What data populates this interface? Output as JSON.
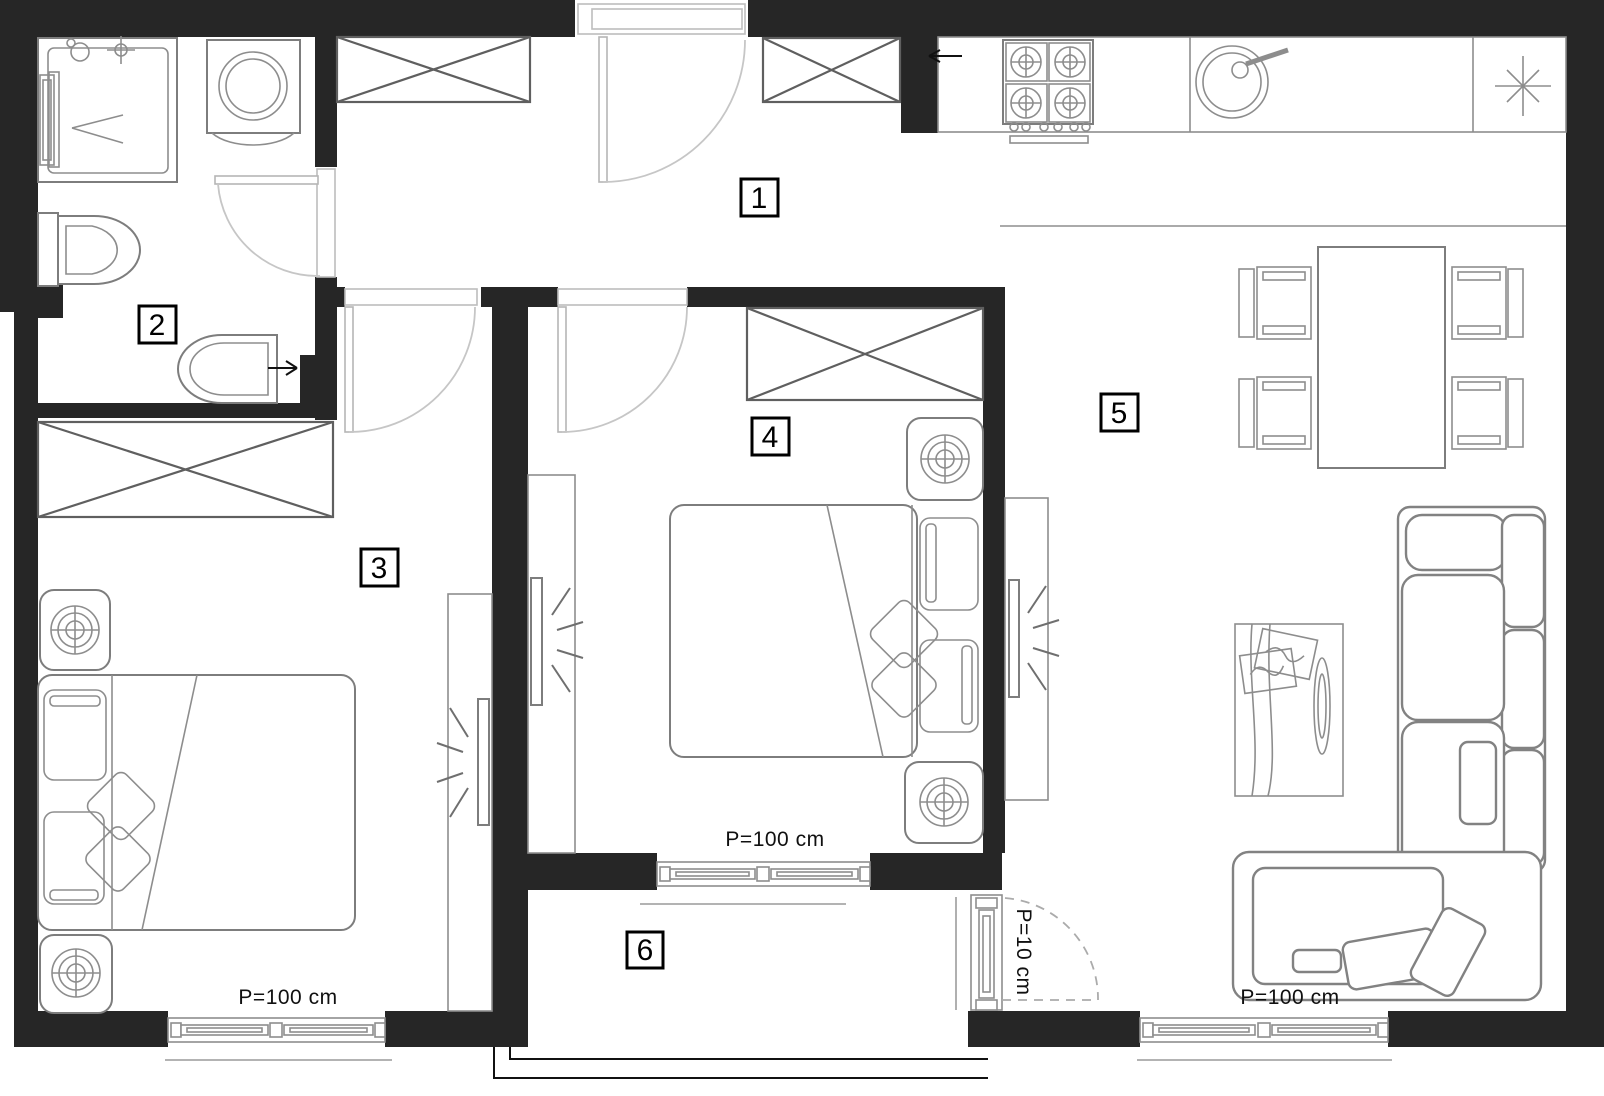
{
  "plan": {
    "room_labels": [
      {
        "label": "1"
      },
      {
        "label": "2"
      },
      {
        "label": "3"
      },
      {
        "label": "4"
      },
      {
        "label": "5"
      },
      {
        "label": "6"
      }
    ],
    "dimension_labels": {
      "window_room3": "P=100 cm",
      "window_room4": "P=100 cm",
      "window_living": "P=100 cm",
      "balcony_door": "P=10 cm"
    },
    "colors": {
      "wall": "#262626",
      "furniture_outline": "#7d7d7d",
      "door_arc": "#c6c6c6",
      "label_text": "#000000",
      "background": "#ffffff"
    }
  }
}
